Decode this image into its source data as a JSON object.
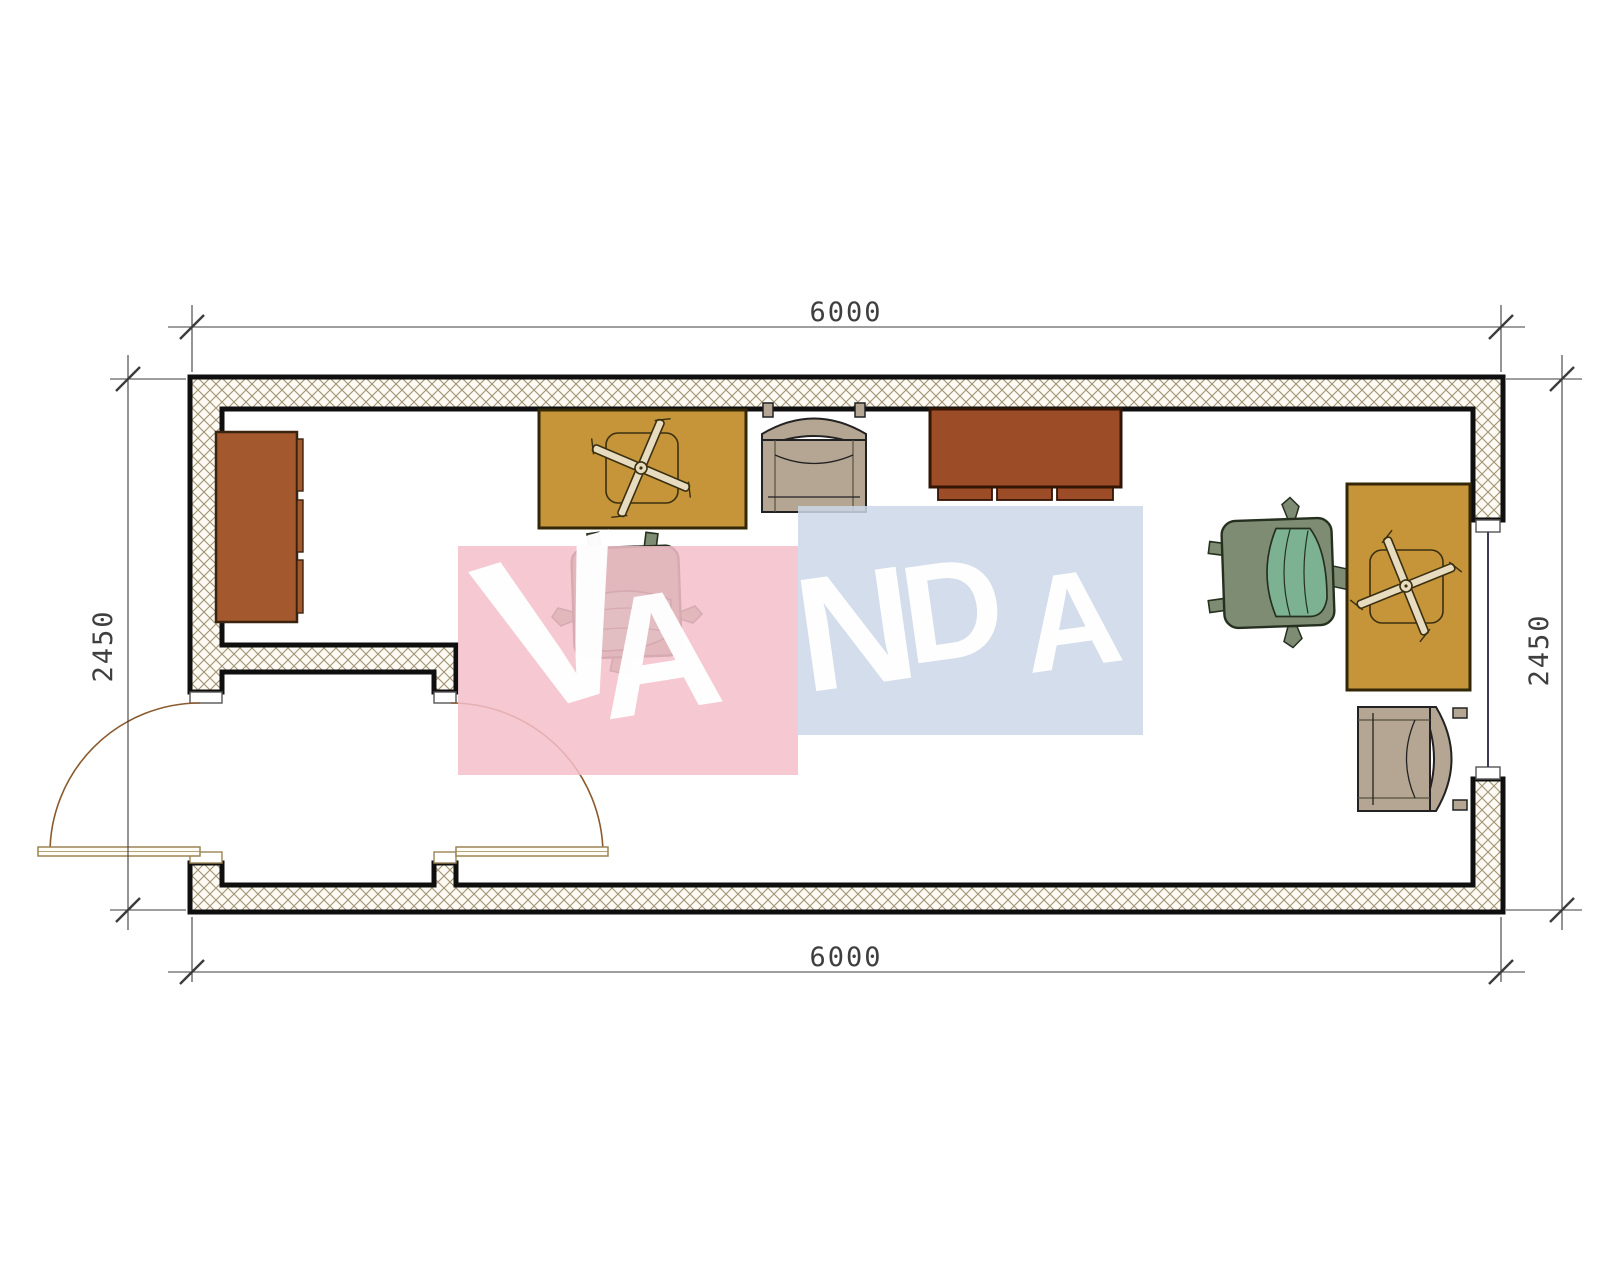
{
  "dimensions": {
    "top": "6000",
    "bottom": "6000",
    "left": "2450",
    "right": "2450"
  },
  "watermark": {
    "text": "VANDA",
    "letters": [
      "V",
      "A",
      "N",
      "D",
      "A"
    ],
    "pink_block_color": "#F5C0CA",
    "blue_block_color": "#CBD7E7",
    "text_color": "#FFFFFF"
  },
  "plan": {
    "wall": {
      "fill": "#FCFAF2",
      "hatch_line": "#A09274",
      "edge": "#0F0F0F"
    },
    "door": {
      "leaf_color": "#9B8455",
      "swing_arc_color": "#8A5A2E"
    },
    "window": {
      "glass_line_color": "#3A3A5C"
    },
    "dimension_color": "#3C3C3C",
    "furniture": [
      {
        "name": "wardrobe",
        "color": "#A3592D"
      },
      {
        "name": "desk-left",
        "color": "#C6953A"
      },
      {
        "name": "armchair-top",
        "color": "#B5A593"
      },
      {
        "name": "sideboard",
        "color": "#9C4D27"
      },
      {
        "name": "office-chair-left",
        "color": "#7CB292"
      },
      {
        "name": "office-chair-right",
        "color": "#7CB292"
      },
      {
        "name": "desk-right",
        "color": "#C6953A"
      },
      {
        "name": "armchair-right",
        "color": "#B5A593"
      }
    ]
  }
}
